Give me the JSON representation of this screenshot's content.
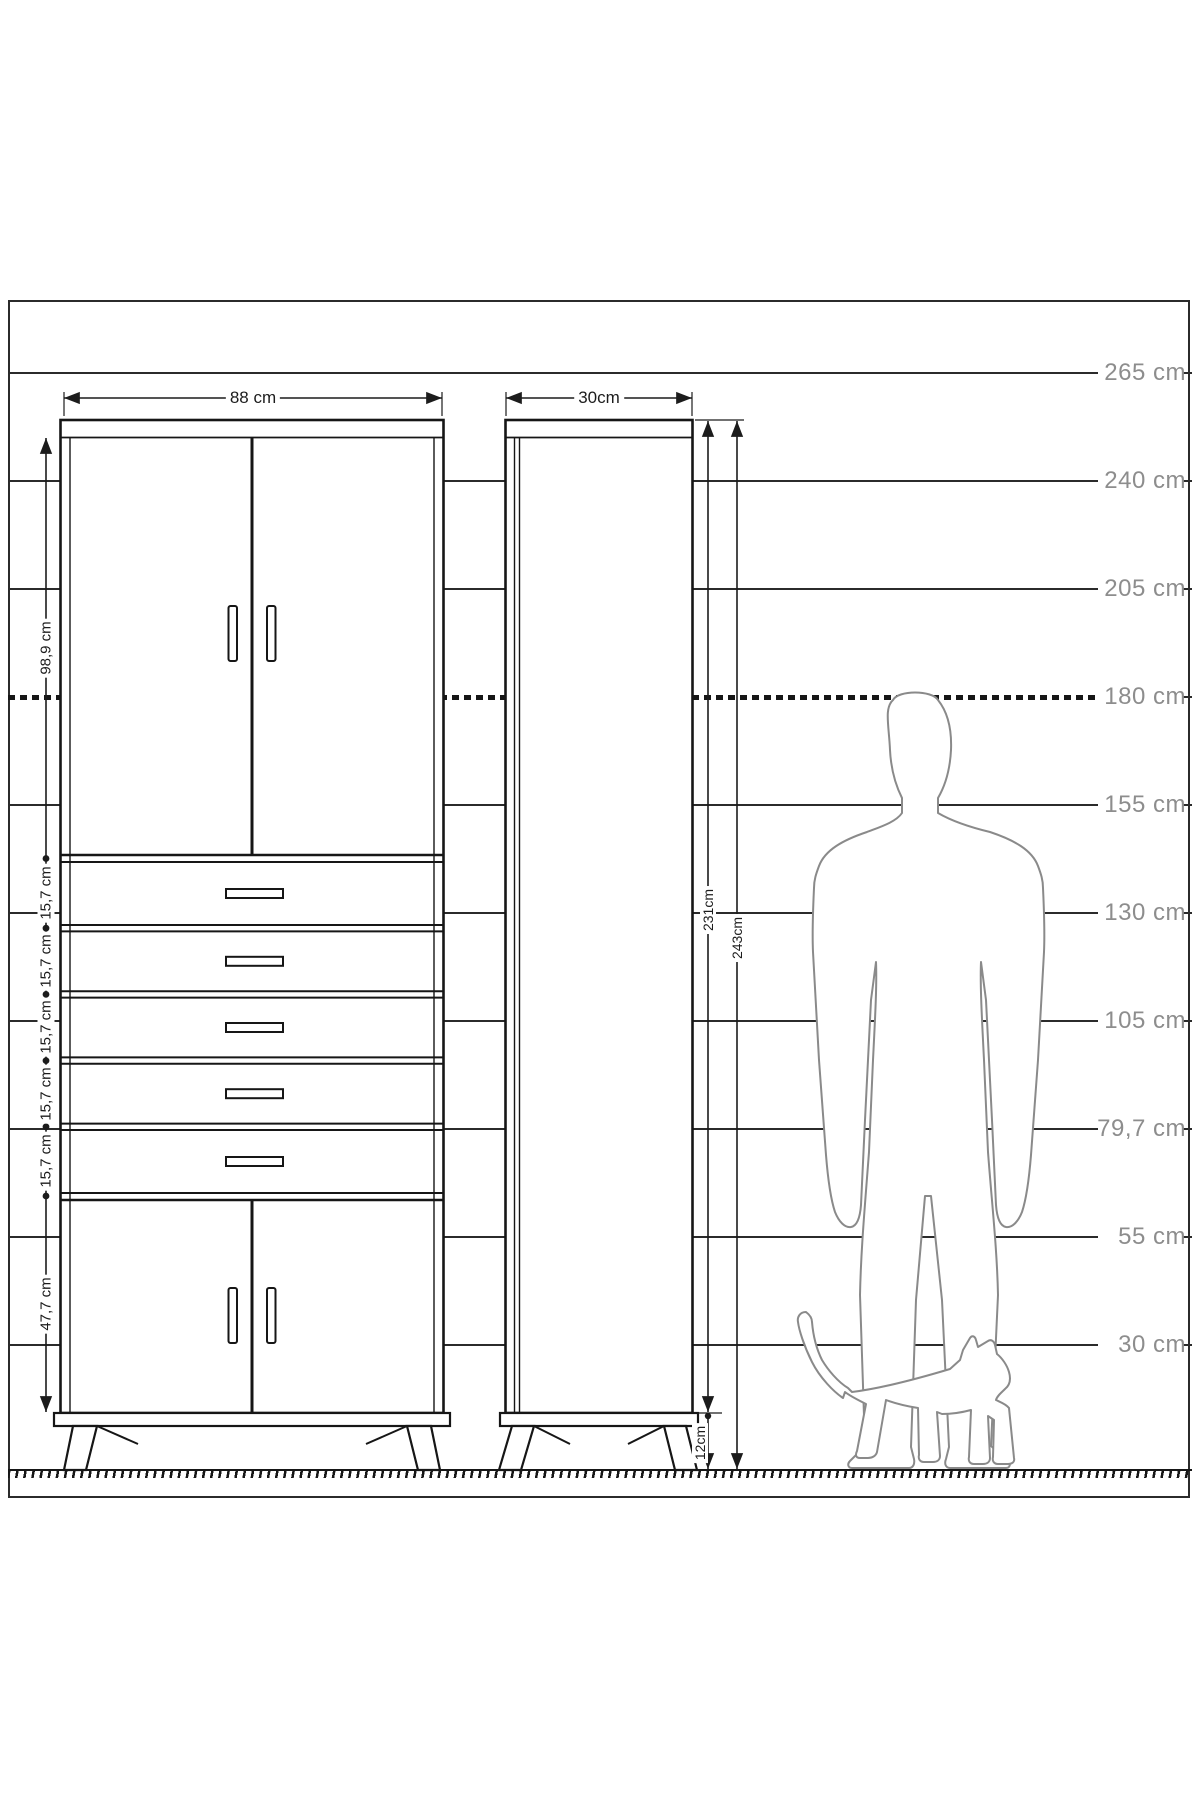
{
  "scale": {
    "labels": [
      "265 cm",
      "240 cm",
      "205 cm",
      "180 cm",
      "155 cm",
      "130 cm",
      "105 cm",
      "79,7 cm",
      "55 cm",
      "30 cm"
    ]
  },
  "front_view": {
    "width_label": "88 cm",
    "top_doors_label": "98,9 cm",
    "drawer_labels": [
      "15,7 cm",
      "15,7 cm",
      "15,7 cm",
      "15,7 cm",
      "15,7 cm"
    ],
    "bottom_doors_label": "47,7 cm"
  },
  "side_view": {
    "width_label": "30cm",
    "body_height_label": "231cm",
    "total_height_label": "243cm",
    "leg_height_label": "12cm"
  },
  "colors": {
    "line": "#1c1c1c",
    "scale_label": "#8d8d8d",
    "silhouette": "#8a8a8a"
  }
}
